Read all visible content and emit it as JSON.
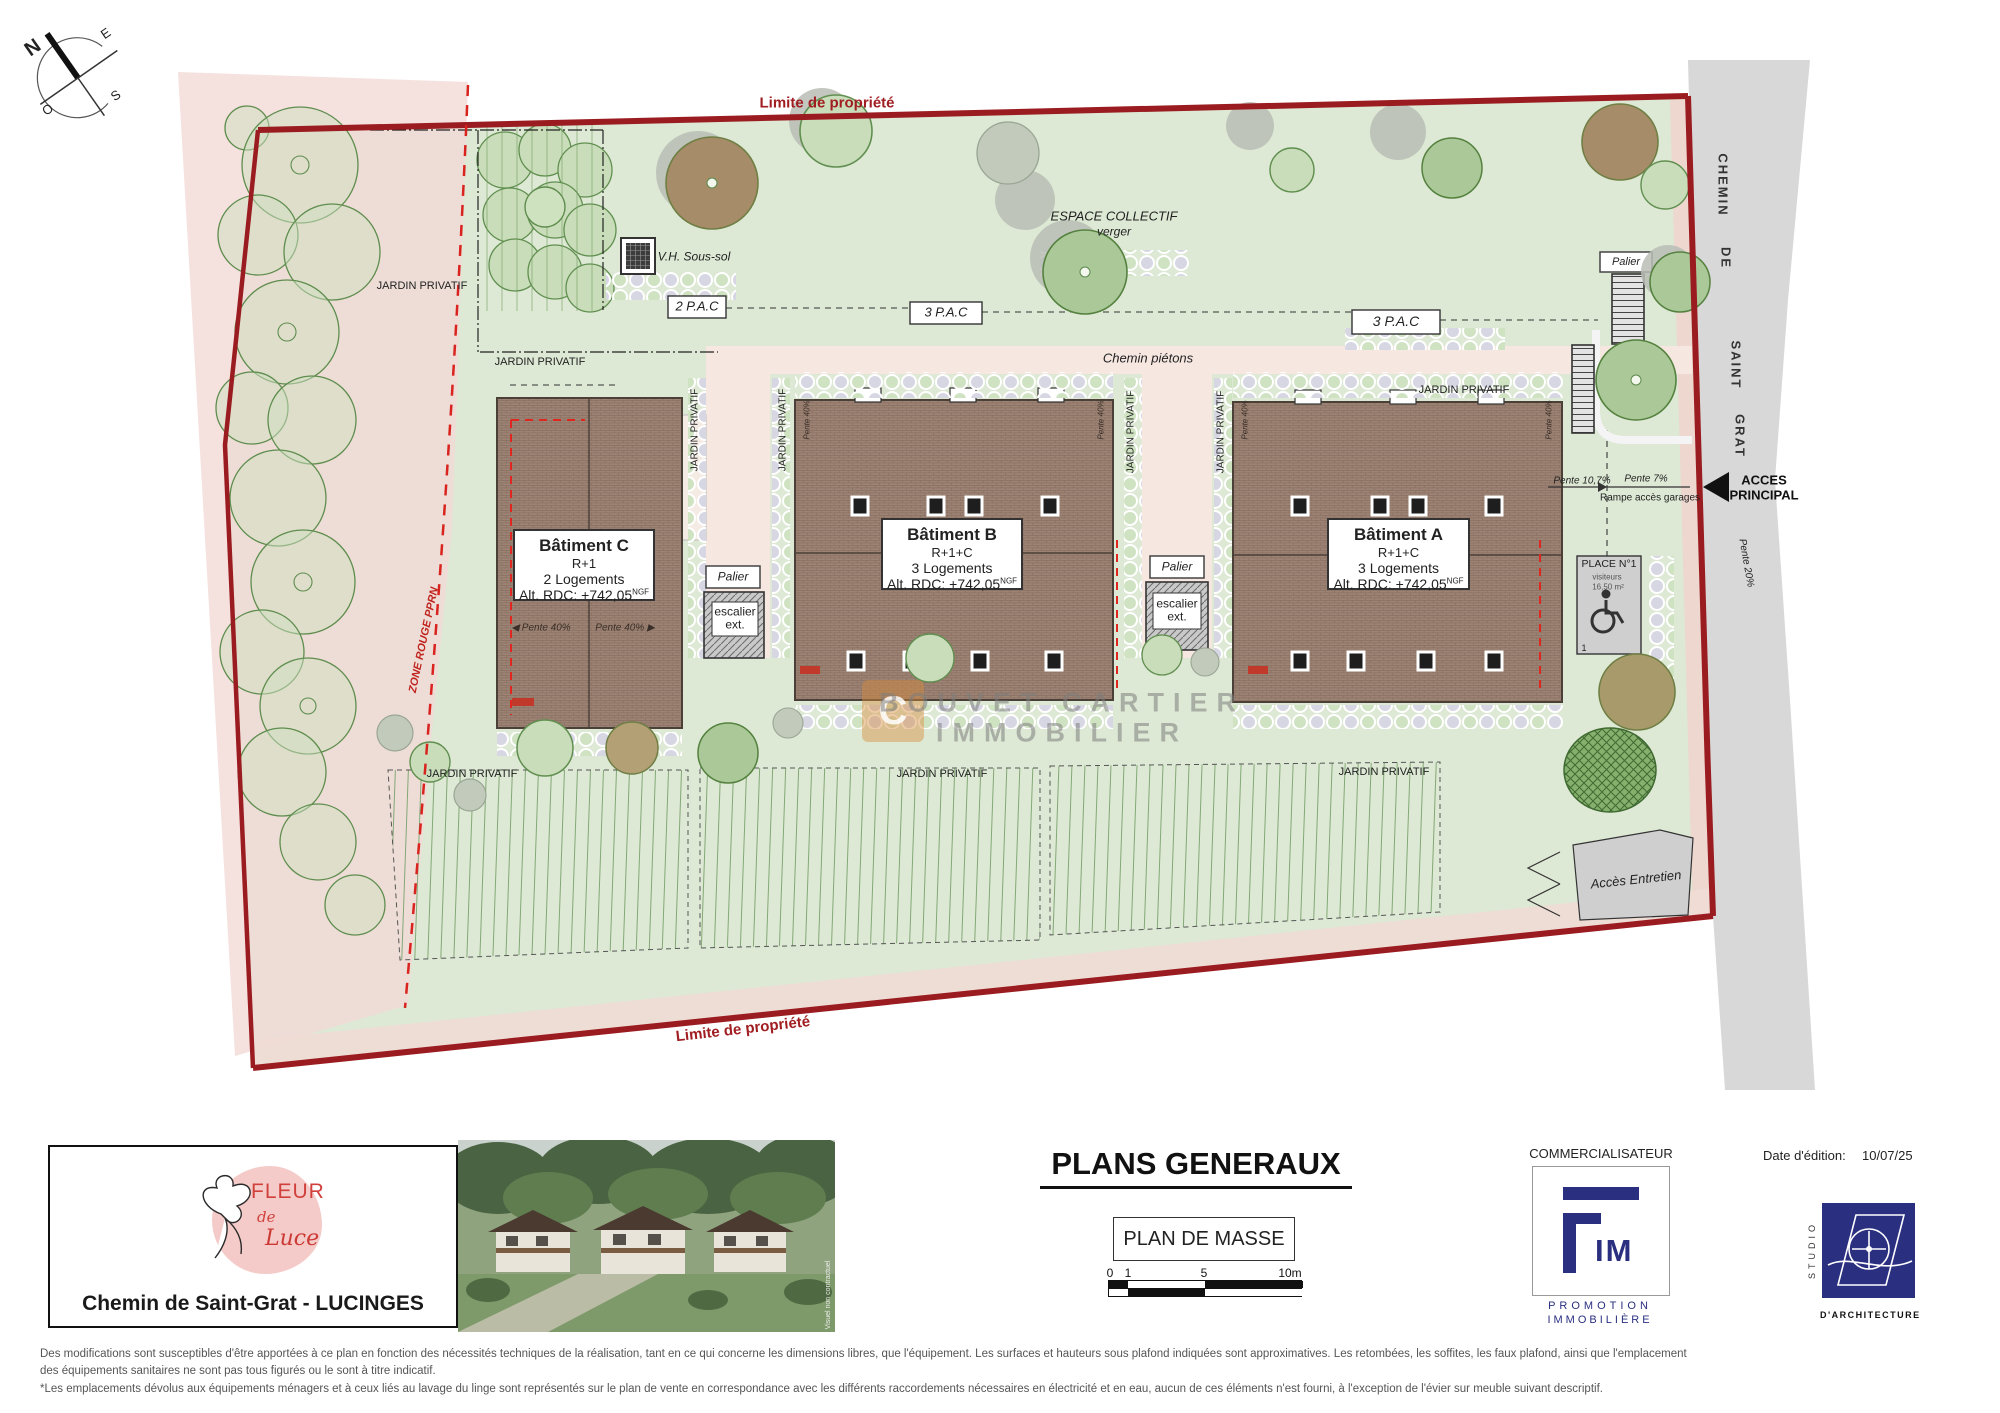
{
  "compass": {
    "n": "N",
    "e": "E",
    "s": "S",
    "o": "O"
  },
  "icons": {
    "wheelchair": "♿",
    "arrow_left": "◀",
    "arrow_right": "▶",
    "acces_arrow": "◀"
  },
  "plan": {
    "property_limit_top": "Limite de propriété",
    "property_limit_bottom": "Limite de propriété",
    "espace_collectif": "ESPACE COLLECTIF",
    "espace_collectif_sub": "verger",
    "vh_sous_sol": "V.H. Sous-sol",
    "pac_2": "2 P.A.C",
    "pac_3": "3 P.A.C",
    "jardin_privatif": "JARDIN PRIVATIF",
    "chemin_pietons": "Chemin piétons",
    "zone_rouge": "ZONE ROUGE PPRN",
    "road": {
      "w1": "CHEMIN",
      "w2": "DE",
      "w3": "SAINT",
      "w4": "GRAT"
    },
    "acces_l1": "ACCES",
    "acces_l2": "PRINCIPAL",
    "pente_10": "Pente 10,7%",
    "pente_7": "Pente 7%",
    "rampe": "Rampe accès garages",
    "pente_20": "Pente 20%",
    "pente_40": "Pente 40%",
    "palier": "Palier",
    "escalier_l1": "escalier",
    "escalier_l2": "ext.",
    "place": {
      "title": "PLACE N°1",
      "sub": "visiteurs",
      "area": "16,50 m²",
      "num": "1"
    },
    "acces_entretien": "Accès Entretien",
    "buildings": {
      "c": {
        "name": "Bâtiment C",
        "level": "R+1",
        "units": "2 Logements",
        "alt": "Alt. RDC: +742,05",
        "alt_sup": "NGF"
      },
      "b": {
        "name": "Bâtiment B",
        "level": "R+1+C",
        "units": "3 Logements",
        "alt": "Alt. RDC: +742,05",
        "alt_sup": "NGF"
      },
      "a": {
        "name": "Bâtiment A",
        "level": "R+1+C",
        "units": "3 Logements",
        "alt": "Alt. RDC: +742,05",
        "alt_sup": "NGF"
      }
    },
    "watermark": {
      "l1": "BOUVET CARTIER",
      "l2": "IMMOBILIER",
      "logo_letter": "C"
    }
  },
  "titleblock": {
    "logo": {
      "fleur": "FLEUR",
      "de": "de",
      "luce": "Luce"
    },
    "address": "Chemin de Saint-Grat - LUCINGES",
    "photo_note": "Visuel non contractuel",
    "title": "PLANS GENERAUX",
    "subtitle": "PLAN DE MASSE",
    "scale": {
      "t0": "0",
      "t1": "1",
      "t5": "5",
      "t10": "10m"
    },
    "commercialisateur": "COMMERCIALISATEUR",
    "fim": {
      "letters": "IM",
      "line1": "PROMOTION",
      "line2": "IMMOBILIÈRE"
    },
    "date_label": "Date d'édition:",
    "date_value": "10/07/25",
    "studio": {
      "vertical": "STUDIO",
      "bottom": "D'ARCHITECTURE"
    }
  },
  "disclaimer": {
    "line1": "Des modifications sont susceptibles d'être apportées à ce plan en fonction des nécessités techniques de la réalisation, tant en ce qui concerne les dimensions libres, que l'équipement. Les surfaces et hauteurs sous plafond indiquées sont approximatives. Les retombées, les soffites, les faux plafond, ainsi que l'emplacement",
    "line2": "des équipements sanitaires ne sont pas tous figurés ou le sont à titre indicatif.",
    "line3": "*Les emplacements dévolus aux équipements ménagers et à ceux liés au lavage du linge sont représentés sur le plan de vente en correspondance avec les différents raccordements nécessaires en électricité et en eau, aucun de ces éléments n'est fourni, à l'exception de l'évier sur meuble suivant descriptif."
  },
  "colors": {
    "property_line": "#9a1c20",
    "zone_pink": "#f3d9d6",
    "parcel_green": "#dde9d5",
    "road_gray": "#d8d8d8",
    "building_brown": "#9c8374",
    "path_pink": "#f6e7e1",
    "navy": "#2a2f80",
    "label_red": "#a01d21"
  }
}
